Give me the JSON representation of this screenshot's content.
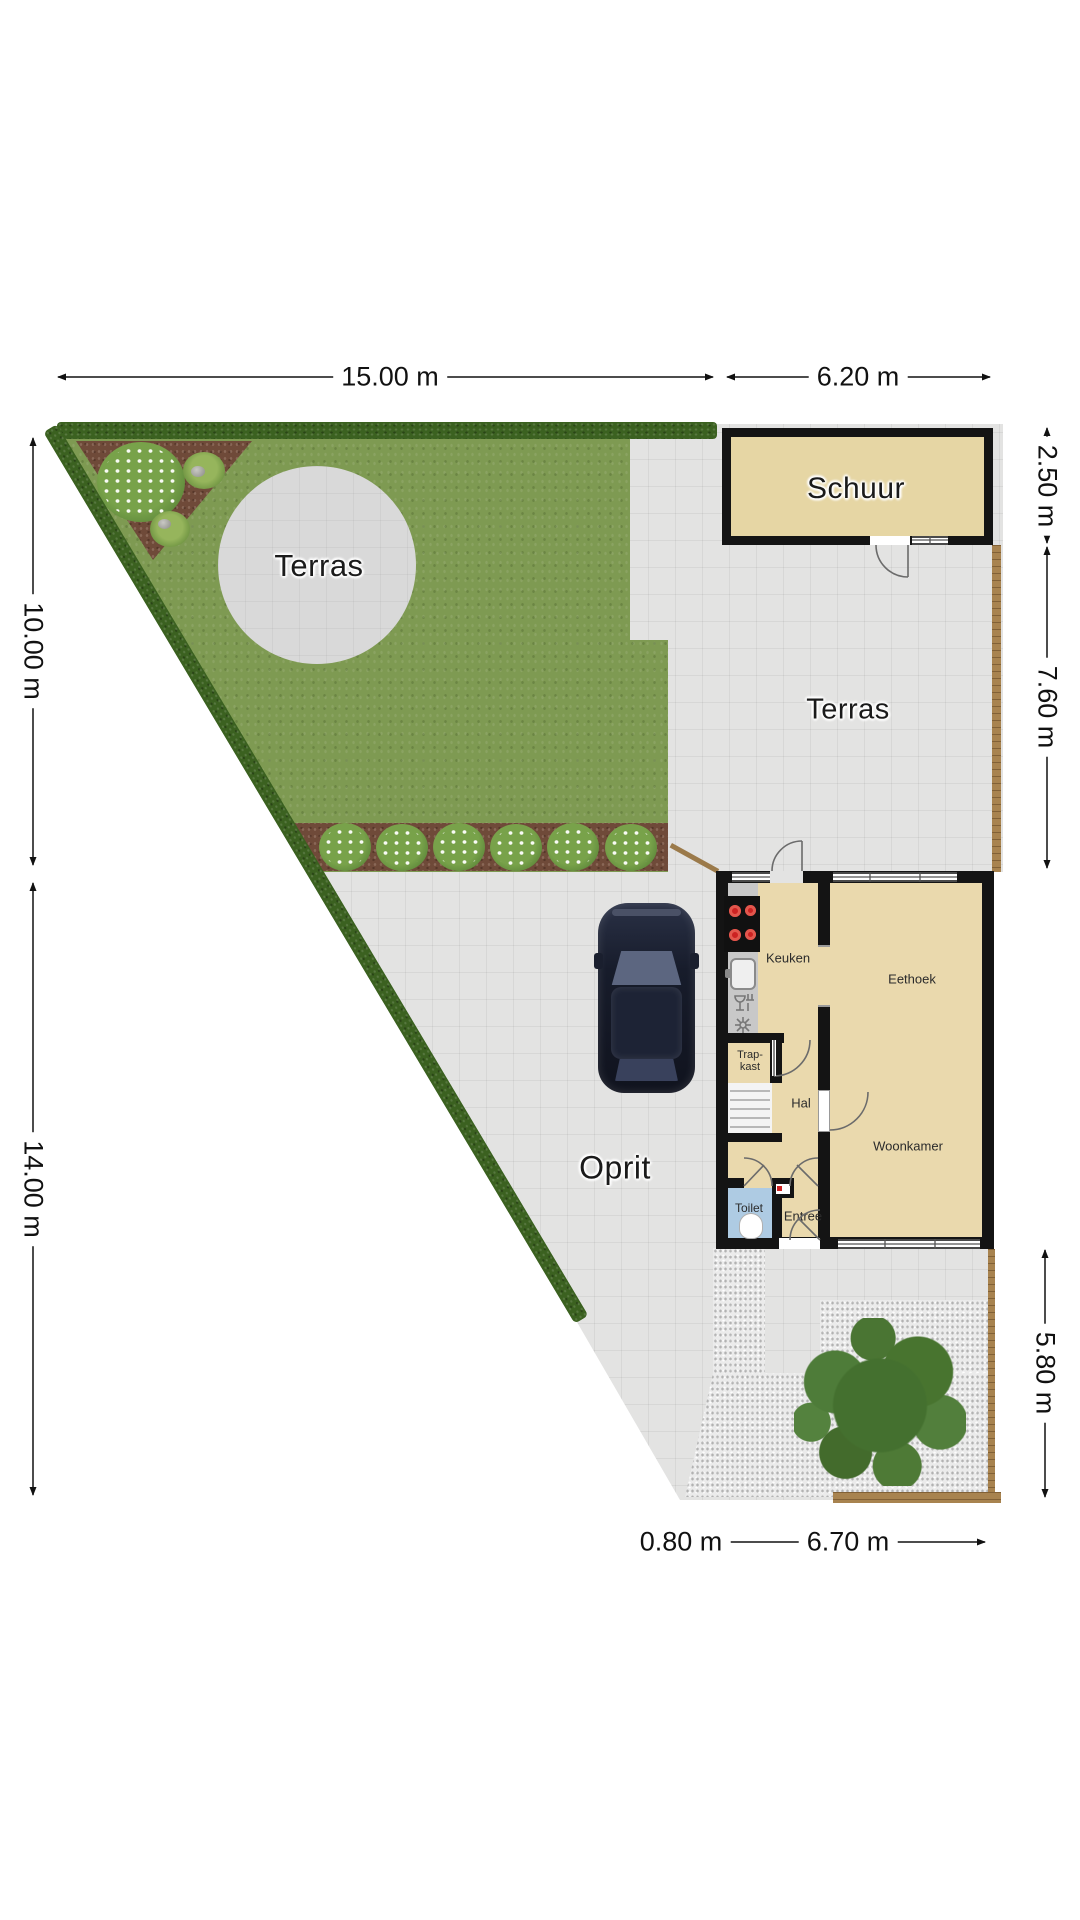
{
  "plan": {
    "areas": {
      "garden_terrace": "Terras",
      "shed": "Schuur",
      "paved_terrace": "Terras",
      "driveway": "Oprit"
    },
    "rooms": {
      "kitchen": "Keuken",
      "dining": "Eethoek",
      "stair_closet_line1": "Trap-",
      "stair_closet_line2": "kast",
      "hallway": "Hal",
      "living": "Woonkamer",
      "toilet": "Toilet",
      "entrance": "Entree"
    },
    "dimensions": {
      "garden_width": "15.00 m",
      "shed_width": "6.20 m",
      "garden_depth": "10.00 m",
      "driveway_depth": "14.00 m",
      "shed_depth": "2.50 m",
      "terrace_depth": "7.60 m",
      "backyard_depth": "5.80 m",
      "side_strip_width": "0.80 m",
      "house_width": "6.70 m"
    },
    "colors": {
      "grass": "#7e9a52",
      "paving": "#e3e3e2",
      "hedge": "#3b6120",
      "soil": "#6f4a39",
      "shed_fill": "#e6d6a4",
      "house_fill": "#ead9ad",
      "wall": "#141414",
      "toilet_floor": "#aecbe3",
      "gravel": "#ebebeb",
      "fence": "#a8834f",
      "tree": "#4a7533",
      "car": "#1c2333",
      "cooktop_burner": "#cc2222"
    },
    "icons": {
      "cooktop": "cooktop-icon",
      "sink": "sink-icon",
      "dishwasher": "dishwasher-icon",
      "extractor": "extractor-fan-icon",
      "toilet_bowl": "toilet-bowl-icon",
      "meter_cupboard": "meter-cupboard-icon",
      "stairs": "stairs-icon",
      "tree": "tree-icon",
      "car": "car-icon",
      "flower_bush": "flower-bush-icon"
    }
  }
}
